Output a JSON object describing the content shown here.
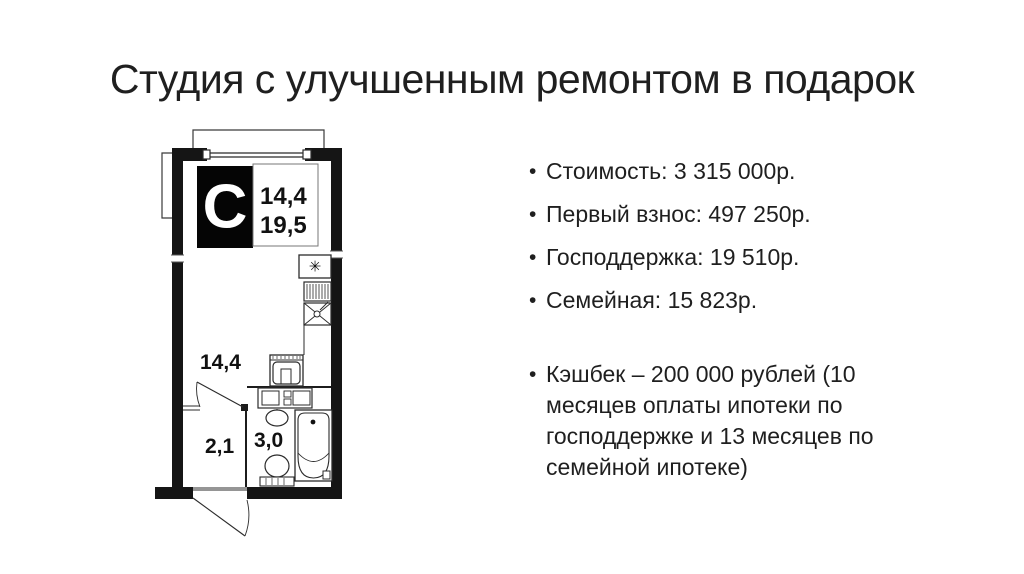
{
  "slide": {
    "title": "Студия с улучшенным ремонтом в подарок",
    "bullets": [
      "Стоимость: 3 315 000р.",
      "Первый взнос: 497 250р.",
      "Господдержка: 19 510р.",
      "Семейная: 15 823р."
    ],
    "cashback_bullet": "Кэшбек – 200 000 рублей (10 месяцев оплаты ипотеки по господдержке и 13 месяцев по семейной ипотеке)"
  },
  "floorplan": {
    "logo_letter": "C",
    "info_box": {
      "line1": "14,4",
      "line2": "19,5"
    },
    "labels": {
      "room": "14,4",
      "hallway": "2,1",
      "bathroom": "3,0"
    },
    "vent_symbol": "✳"
  },
  "colors": {
    "background": "#ffffff",
    "title_text": "#1f1f1f",
    "body_text": "#1f1f1f",
    "plan_line": "#1c1c1c",
    "logo_bg": "#050505",
    "logo_letter": "#ffffff"
  }
}
